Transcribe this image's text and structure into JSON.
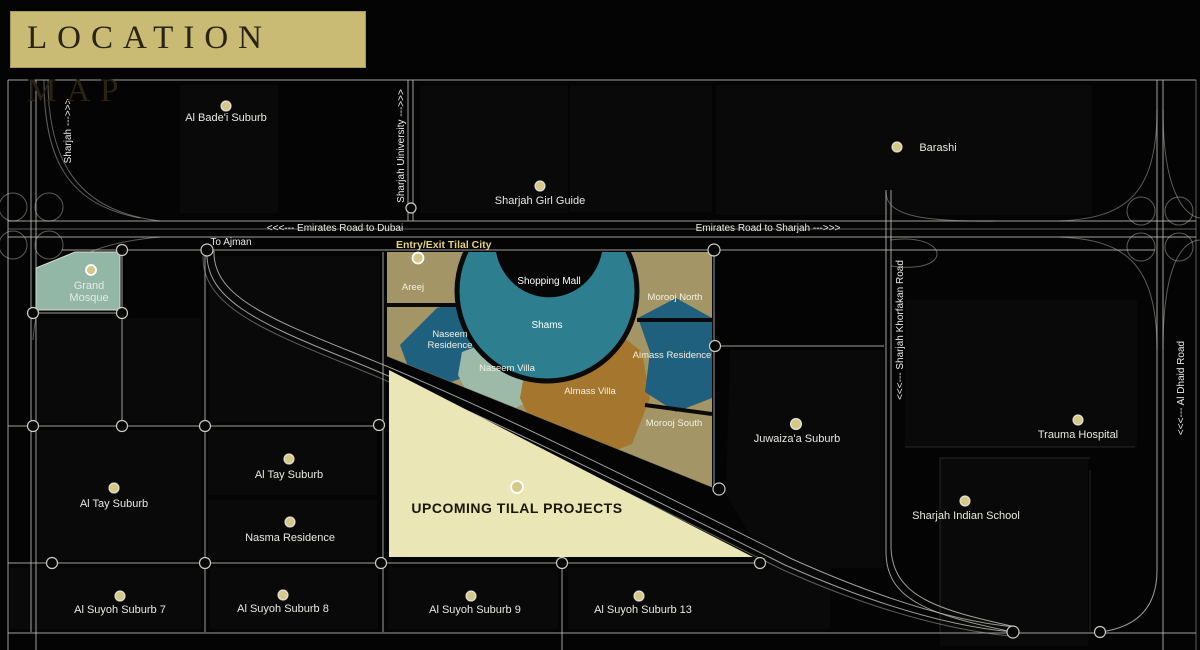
{
  "banner": {
    "title": "LOCATION MAP"
  },
  "map": {
    "colors": {
      "banner_bg": "#c9ba74",
      "banner_text": "#2a2313",
      "background": "#040404",
      "road_line": "#c6c6c0",
      "marker_dot": "#d5c98a",
      "gold_label": "#e5d17e",
      "zone_tan": "#a39565",
      "zone_teal": "#2d7f90",
      "zone_blue": "#20607f",
      "zone_sage": "#9dbaa9",
      "zone_brown": "#a5762e",
      "zone_mall": "#060606",
      "zone_cream": "#eae6b6",
      "mosque_fill": "#92b7a7"
    },
    "road_labels": {
      "emirates_dubai": "<<<---  Emirates Road  to Dubai",
      "emirates_sharjah": "Emirates Road  to Sharjah --->>>",
      "to_ajman": "To Ajman",
      "sharjah": "Sharjah  --->>>",
      "sharjah_university": "Sharjah Uiniversity  --->>>",
      "khorfakan": "<<<---  Sharjah Khorfakan Road",
      "al_dhaid": "<<<---  Al Dhaid Road"
    },
    "tilal": {
      "entry_exit": "Entry/Exit Tilal City",
      "upcoming": "UPCOMING TILAL PROJECTS",
      "zones": {
        "areej": "Areej",
        "shopping_mall": "Shopping Mall",
        "shams": "Shams",
        "naseem_residence_1": "Naseem",
        "naseem_residence_2": "Residence",
        "naseem_villa": "Naseem Villa",
        "almass_villa": "Almass Villa",
        "almass_residence": "Almass Residence",
        "morooj_north": "Morooj North",
        "morooj_south": "Morooj South"
      }
    },
    "markers": [
      {
        "id": "al-badei-suburb",
        "label": "Al Bade'i Suburb"
      },
      {
        "id": "sharjah-girl-guide",
        "label": "Sharjah Girl Guide"
      },
      {
        "id": "barashi",
        "label": "Barashi"
      },
      {
        "id": "grand-mosque",
        "label": "Grand",
        "label2": "Mosque"
      },
      {
        "id": "juwaizaa-suburb",
        "label": "Juwaiza'a Suburb"
      },
      {
        "id": "trauma-hospital",
        "label": "Trauma Hospital"
      },
      {
        "id": "sharjah-indian-school",
        "label": "Sharjah Indian School"
      },
      {
        "id": "al-tay-suburb-west",
        "label": "Al Tay Suburb"
      },
      {
        "id": "al-tay-suburb-east",
        "label": "Al Tay Suburb"
      },
      {
        "id": "nasma-residence",
        "label": "Nasma Residence"
      },
      {
        "id": "al-suyoh-suburb-7",
        "label": "Al Suyoh Suburb 7"
      },
      {
        "id": "al-suyoh-suburb-8",
        "label": "Al Suyoh Suburb 8"
      },
      {
        "id": "al-suyoh-suburb-9",
        "label": "Al Suyoh Suburb 9"
      },
      {
        "id": "al-suyoh-suburb-13",
        "label": "Al Suyoh Suburb 13"
      }
    ]
  }
}
